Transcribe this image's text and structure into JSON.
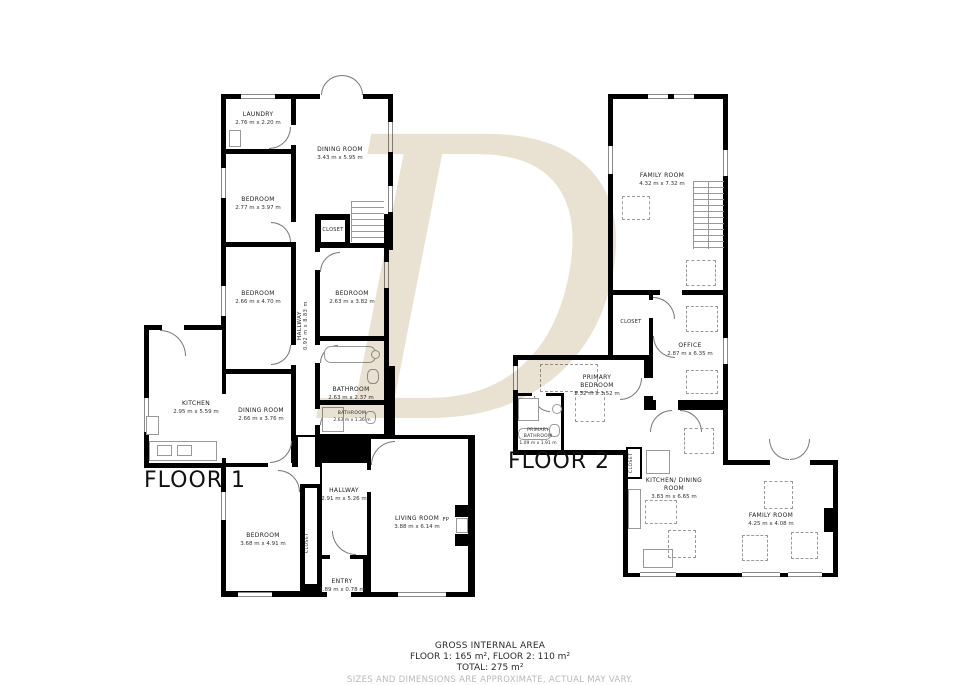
{
  "watermark": "D",
  "floor1": {
    "label": "FLOOR 1",
    "rooms": {
      "laundry": {
        "name": "LAUNDRY",
        "dims": "2.76 m x 2.20 m"
      },
      "dining_top": {
        "name": "DINING ROOM",
        "dims": "3.43 m x 5.95 m"
      },
      "bedroom_top": {
        "name": "BEDROOM",
        "dims": "2.77 m x 3.97 m"
      },
      "bedroom_mid": {
        "name": "BEDROOM",
        "dims": "2.66 m x 4.70 m"
      },
      "closet_upper": {
        "name": "CLOSET"
      },
      "hallway_upper": {
        "name": "HALLWAY",
        "dims": "0.92 m x 8.83 m"
      },
      "bedroom_right": {
        "name": "BEDROOM",
        "dims": "2.63 m x 3.82 m"
      },
      "bathroom_large": {
        "name": "BATHROOM",
        "dims": "2.63 m x 2.37 m"
      },
      "bathroom_small": {
        "name": "BATHROOM",
        "dims": "2.63 m x 1.36 m"
      },
      "kitchen": {
        "name": "KITCHEN",
        "dims": "2.95 m x 5.59 m"
      },
      "dining_mid": {
        "name": "DINING ROOM",
        "dims": "2.66 m x 3.76 m"
      },
      "hallway_lower": {
        "name": "HALLWAY",
        "dims": "2.91 m x 5.26 m"
      },
      "bedroom_bottom": {
        "name": "BEDROOM",
        "dims": "3.68 m x 4.91 m"
      },
      "closet_lower": {
        "name": "CLOSET"
      },
      "entry": {
        "name": "ENTRY",
        "dims": "1.89 m x 0.78 m"
      },
      "living_room": {
        "name": "LIVING ROOM",
        "dims": "3.88 m x 6.14 m"
      },
      "fireplace": {
        "name": "FP"
      }
    }
  },
  "floor2": {
    "label": "FLOOR 2",
    "rooms": {
      "family_room_top": {
        "name": "FAMILY ROOM",
        "dims": "4.32 m x 7.32 m"
      },
      "closet_office": {
        "name": "CLOSET"
      },
      "office": {
        "name": "OFFICE",
        "dims": "2.87 m x 6.35 m"
      },
      "primary_bedroom": {
        "name": "PRIMARY BEDROOM",
        "dims": "5.32 m x 3.52 m"
      },
      "primary_bathroom": {
        "name": "PRIMARY BATHROOM",
        "dims": "1.09 m x 1.91 m"
      },
      "closet_kitchen": {
        "name": "CLOSET"
      },
      "kitchen_dining": {
        "name": "KITCHEN/ DINING ROOM",
        "dims": "3.83 m x 6.65 m"
      },
      "family_room_bottom": {
        "name": "FAMILY ROOM",
        "dims": "4.25 m x 4.08 m"
      }
    }
  },
  "footer": {
    "title": "GROSS INTERNAL AREA",
    "floors": "FLOOR 1: 165 m², FLOOR 2: 110 m²",
    "total": "TOTAL: 275 m²",
    "disclaimer": "SIZES AND DIMENSIONS ARE APPROXIMATE, ACTUAL MAY VARY."
  }
}
